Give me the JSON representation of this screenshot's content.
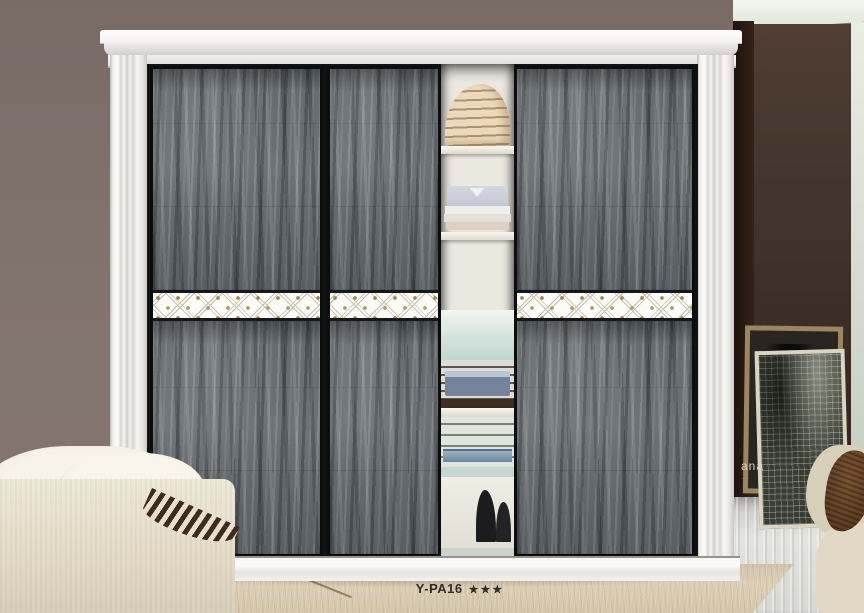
{
  "caption": {
    "model": "Y-PA16",
    "stars": "★★★"
  },
  "poster": {
    "text": "ana"
  },
  "colors": {
    "wall_left": "#7e716c",
    "wall_right": "#46372e",
    "door_gray": "#666b6f",
    "frame_white": "#f5f4f2",
    "band_white": "#fcfbf7",
    "band_gold": "#a1874b",
    "carpet": "#d5c8b0",
    "caption_text": "#2f2d2b"
  }
}
